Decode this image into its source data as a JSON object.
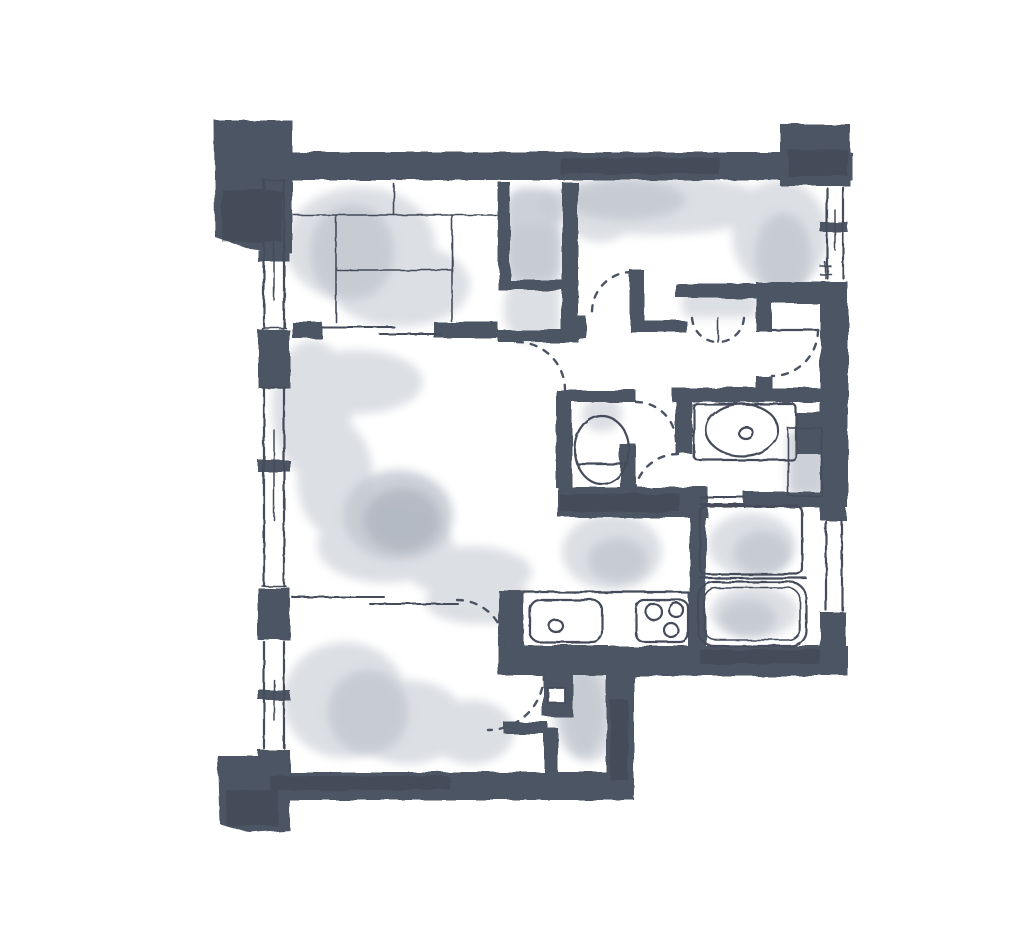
{
  "canvas": {
    "width": 1024,
    "height": 929
  },
  "palette": {
    "paper": "#ffffff",
    "wall": "#4c5463",
    "wall_shade": "#3c4351",
    "line": "#454c5a",
    "dash": "#4b5363",
    "wash_light": "#d9dce1",
    "wash_mid": "#c4c9d1",
    "wash_dark": "#b0b6c1"
  },
  "drawing": {
    "kind": "hand-drawn apartment floor plan, ink outline with gray watercolor wash, no text labels",
    "rooms": [
      {
        "name": "tatami-room",
        "position": "top-left",
        "features": [
          "tatami mat grid",
          "left window",
          "sliding doors on south wall",
          "futon closet on east side"
        ]
      },
      {
        "name": "bedroom",
        "position": "top-right",
        "features": [
          "right window",
          "closet with bi-fold doors",
          "hinged door",
          "large C-shaped wash"
        ]
      },
      {
        "name": "living-room",
        "position": "center-left",
        "features": [
          "tall left window",
          "hinged door to hallway",
          "sliding doors to bedroom-2",
          "large C-shaped wash"
        ]
      },
      {
        "name": "bedroom-2",
        "position": "bottom-left",
        "features": [
          "left window",
          "hinged door",
          "wash blob"
        ]
      },
      {
        "name": "hallway",
        "position": "center",
        "features": [
          "multiple dashed door swing arcs"
        ]
      },
      {
        "name": "toilet-room",
        "position": "center",
        "features": [
          "toilet bowl",
          "hinged door"
        ]
      },
      {
        "name": "washroom",
        "position": "center-right",
        "features": [
          "vanity counter with oval basin",
          "washing machine bay",
          "hinged door"
        ]
      },
      {
        "name": "bathroom",
        "position": "right",
        "features": [
          "bathtub",
          "washing area",
          "double-line folding door",
          "right window"
        ]
      },
      {
        "name": "kitchen",
        "position": "bottom-center",
        "features": [
          "counter",
          "sink with drain",
          "three-burner cooktop"
        ]
      },
      {
        "name": "entry",
        "position": "right",
        "features": [
          "front door leaf with dashed swing arc"
        ]
      }
    ],
    "counts": {
      "windows": 5,
      "door_swing_arcs": 8,
      "corner_pillars": 4
    }
  }
}
